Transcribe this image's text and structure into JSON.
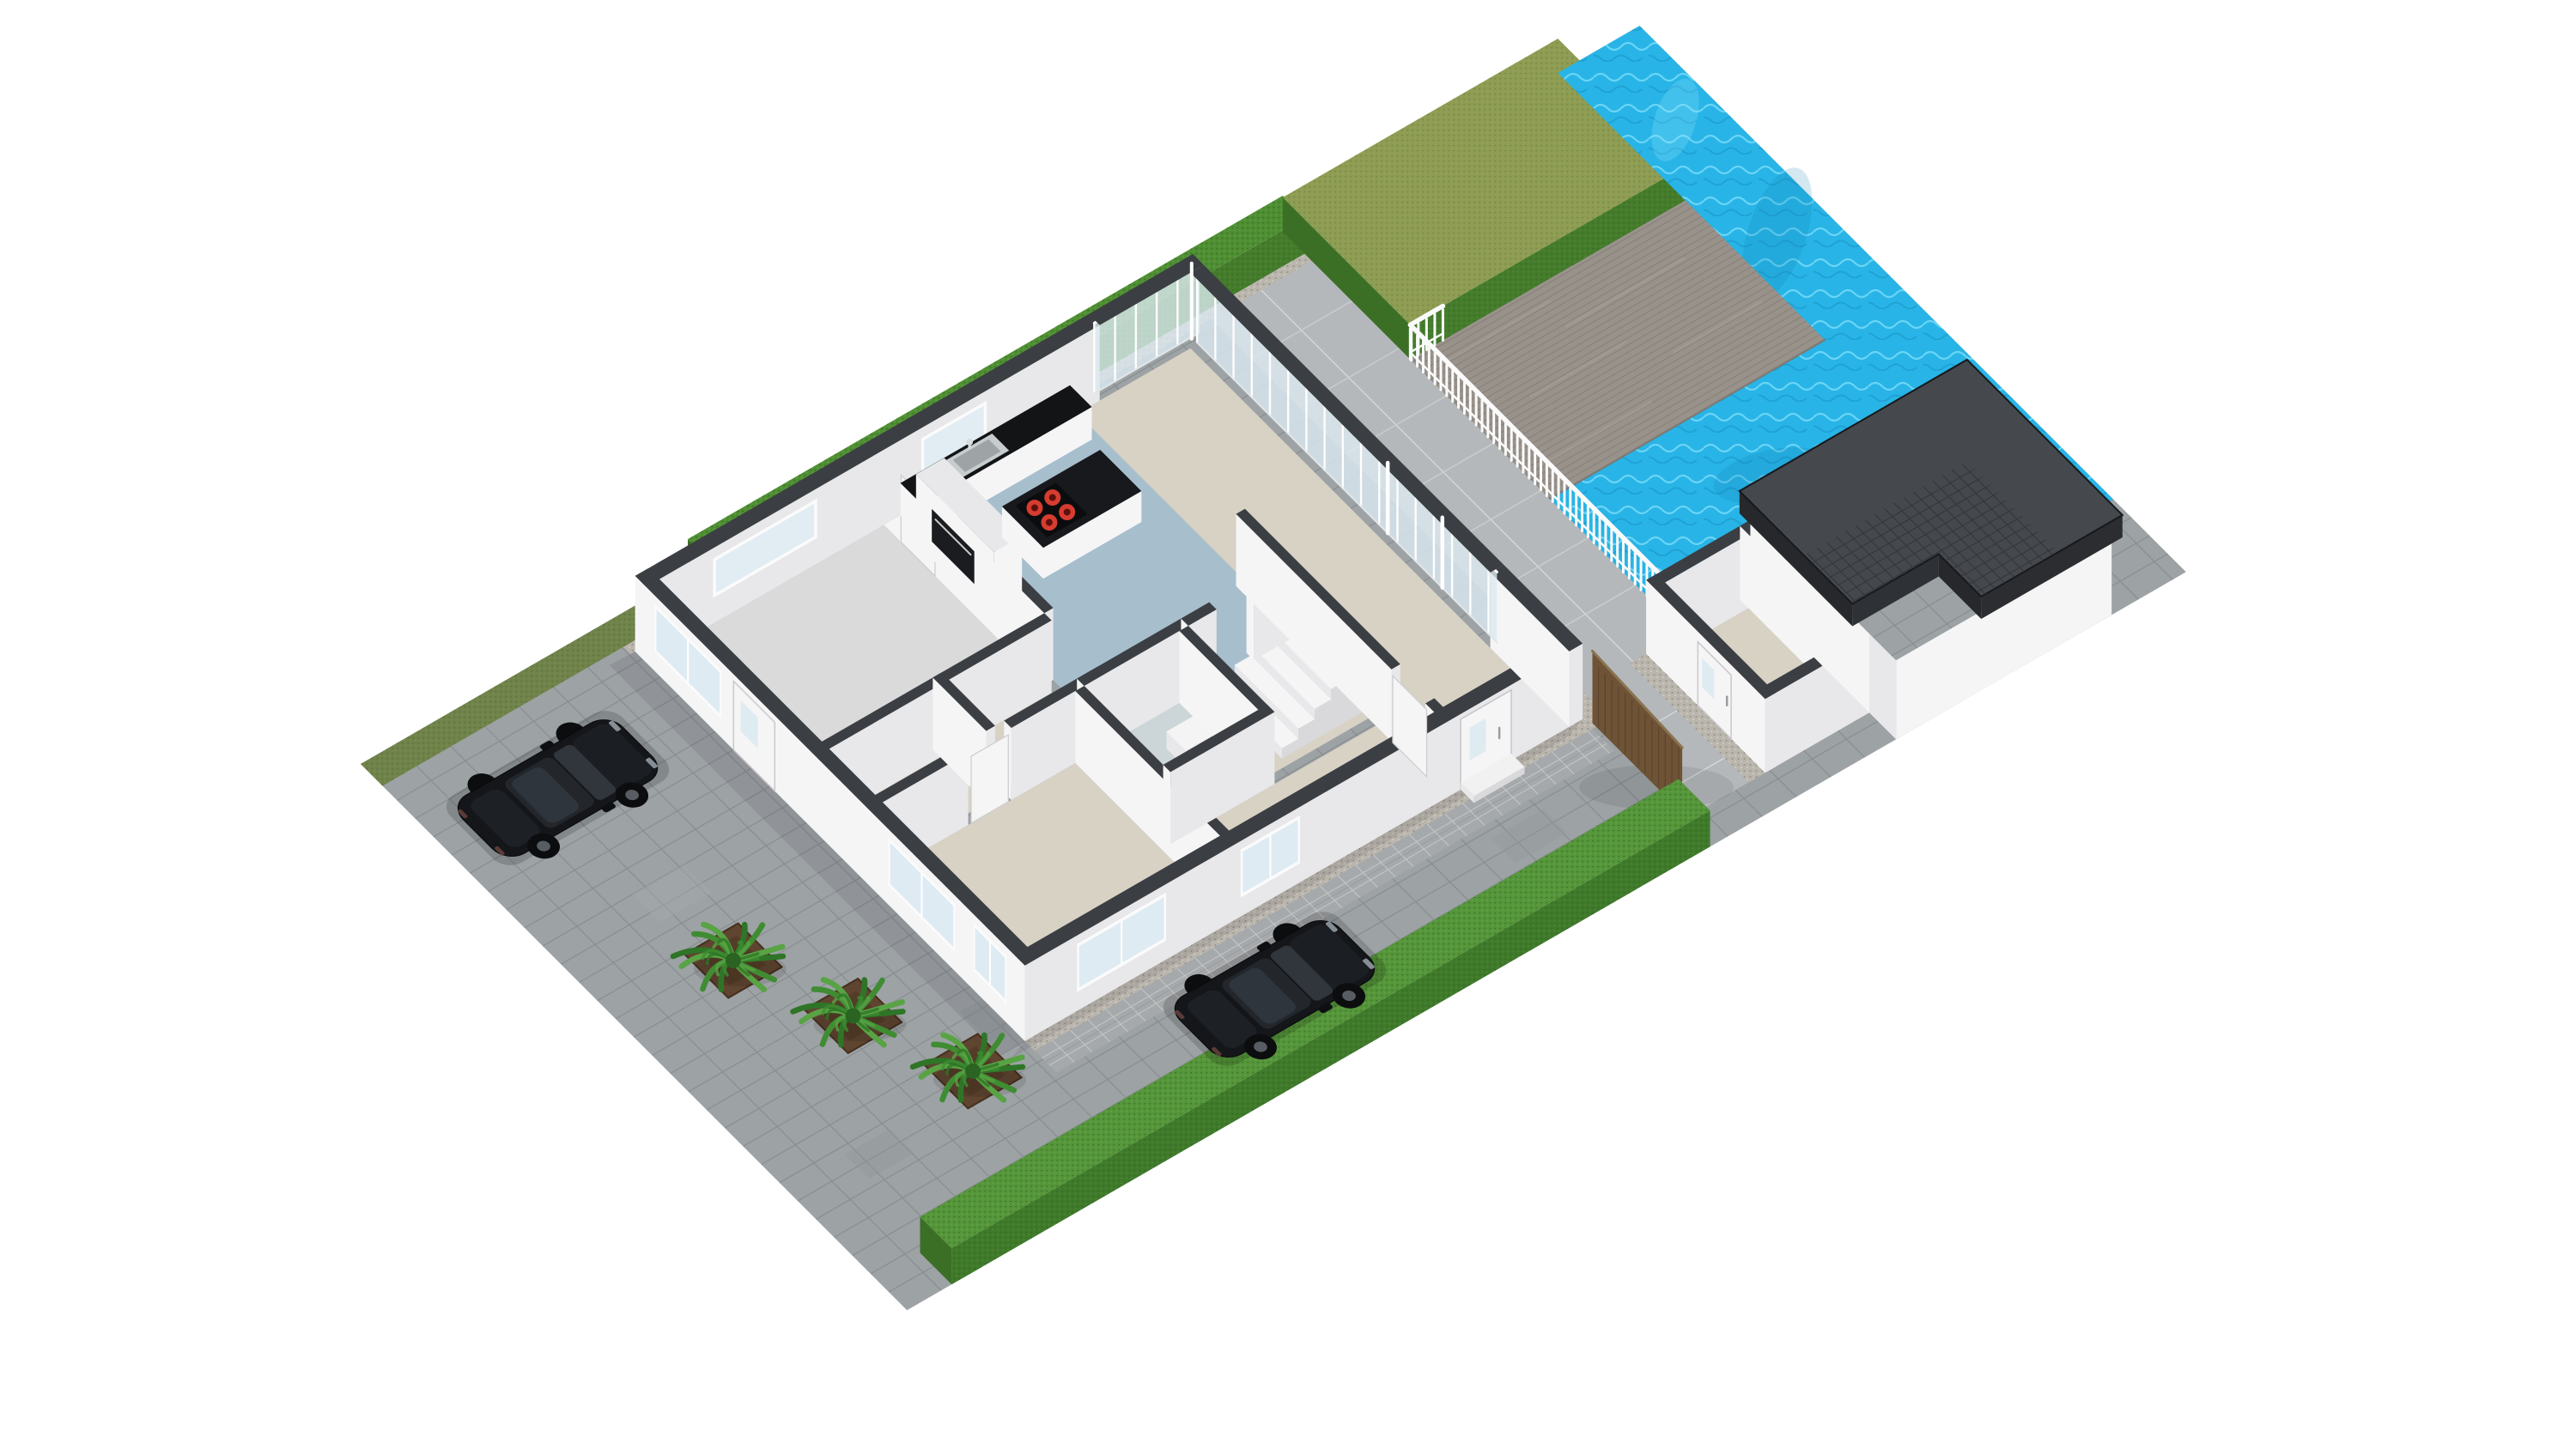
{
  "scene_type": "3d-floorplan-render",
  "background": "#ffffff",
  "colors": {
    "driveway": "#9da2a5",
    "patio": "#b4b8ba",
    "walkway": "#a6a9ab",
    "gravel": "#bab6ad",
    "lawnStrip": "#70834a",
    "hedgeTop": "#4f8f33",
    "hedgeSideL": "#3c6f26",
    "hedgeSideR": "#447c2b",
    "lawnTop": "#8e9d53",
    "pool": "#28b4e6",
    "poolRippleLight": "#8fe6ff",
    "poolRippleDark": "#117fb4",
    "deck": "#99928b",
    "deckLine": "#837c75",
    "railing": "#fafafa",
    "wallCap": "#3b3e43",
    "wallFaceLight": "#f5f5f6",
    "wallFaceMid": "#e8e8ea",
    "wallFaceDark": "#d9d9db",
    "floorRoom": "#dadadb",
    "floorKitchen": "#a7becd",
    "floorLiving": "#d8d2c5",
    "floorBath": "#ccd6d9",
    "counterTop": "#121416",
    "islandTop": "#17191c",
    "appliance": "#1a1c1f",
    "burner": "#d63c30",
    "glass": "#dceaf1",
    "roof": "#45484d",
    "roofLine": "#303338",
    "roofFascia": "#26282c",
    "wood": "#6f5336",
    "woodGrain": "#55402a",
    "carBody": "#14161a",
    "carGlass": "#23272c",
    "carHood": "#1b1e22",
    "wheel": "#0c0d0f",
    "palmDark": "#2f7527",
    "palmMid": "#3f8c32",
    "palmLight": "#58a344",
    "soil": "#5f4530",
    "steel": "#c7ccce"
  },
  "inventory": {
    "rooms": [
      {
        "name": "room-garage",
        "floor": "floorRoom"
      },
      {
        "name": "room-kitchen",
        "floor": "floorKitchen"
      },
      {
        "name": "room-living",
        "floor": "floorLiving"
      },
      {
        "name": "room-hall",
        "floor": "floorLiving"
      },
      {
        "name": "room-bedroom",
        "floor": "floorLiving"
      },
      {
        "name": "room-bathroom",
        "floor": "floorBath"
      },
      {
        "name": "room-stair-hall",
        "floor": "floorLiving"
      },
      {
        "name": "room-hall-2",
        "floor": "floorLiving"
      }
    ],
    "vehicles": [
      {
        "name": "suv-1"
      },
      {
        "name": "suv-2"
      }
    ],
    "palms": [
      {
        "name": "palm-1"
      },
      {
        "name": "palm-2"
      },
      {
        "name": "palm-3"
      }
    ],
    "features": [
      "left-hedge",
      "bottom-hedge",
      "backyard-lawn",
      "swimming-pool",
      "wood-deck",
      "deck-railing",
      "patio-tiles",
      "driveway-pavers",
      "walkway-pavers",
      "gravel-border",
      "kitchen-island",
      "cooktop",
      "kitchen-counter",
      "kitchen-sink",
      "tall-cabinet",
      "oven",
      "staircase",
      "glass-walls",
      "entrance-door",
      "wood-gate",
      "storeroom",
      "garage",
      "garage-roof"
    ]
  }
}
